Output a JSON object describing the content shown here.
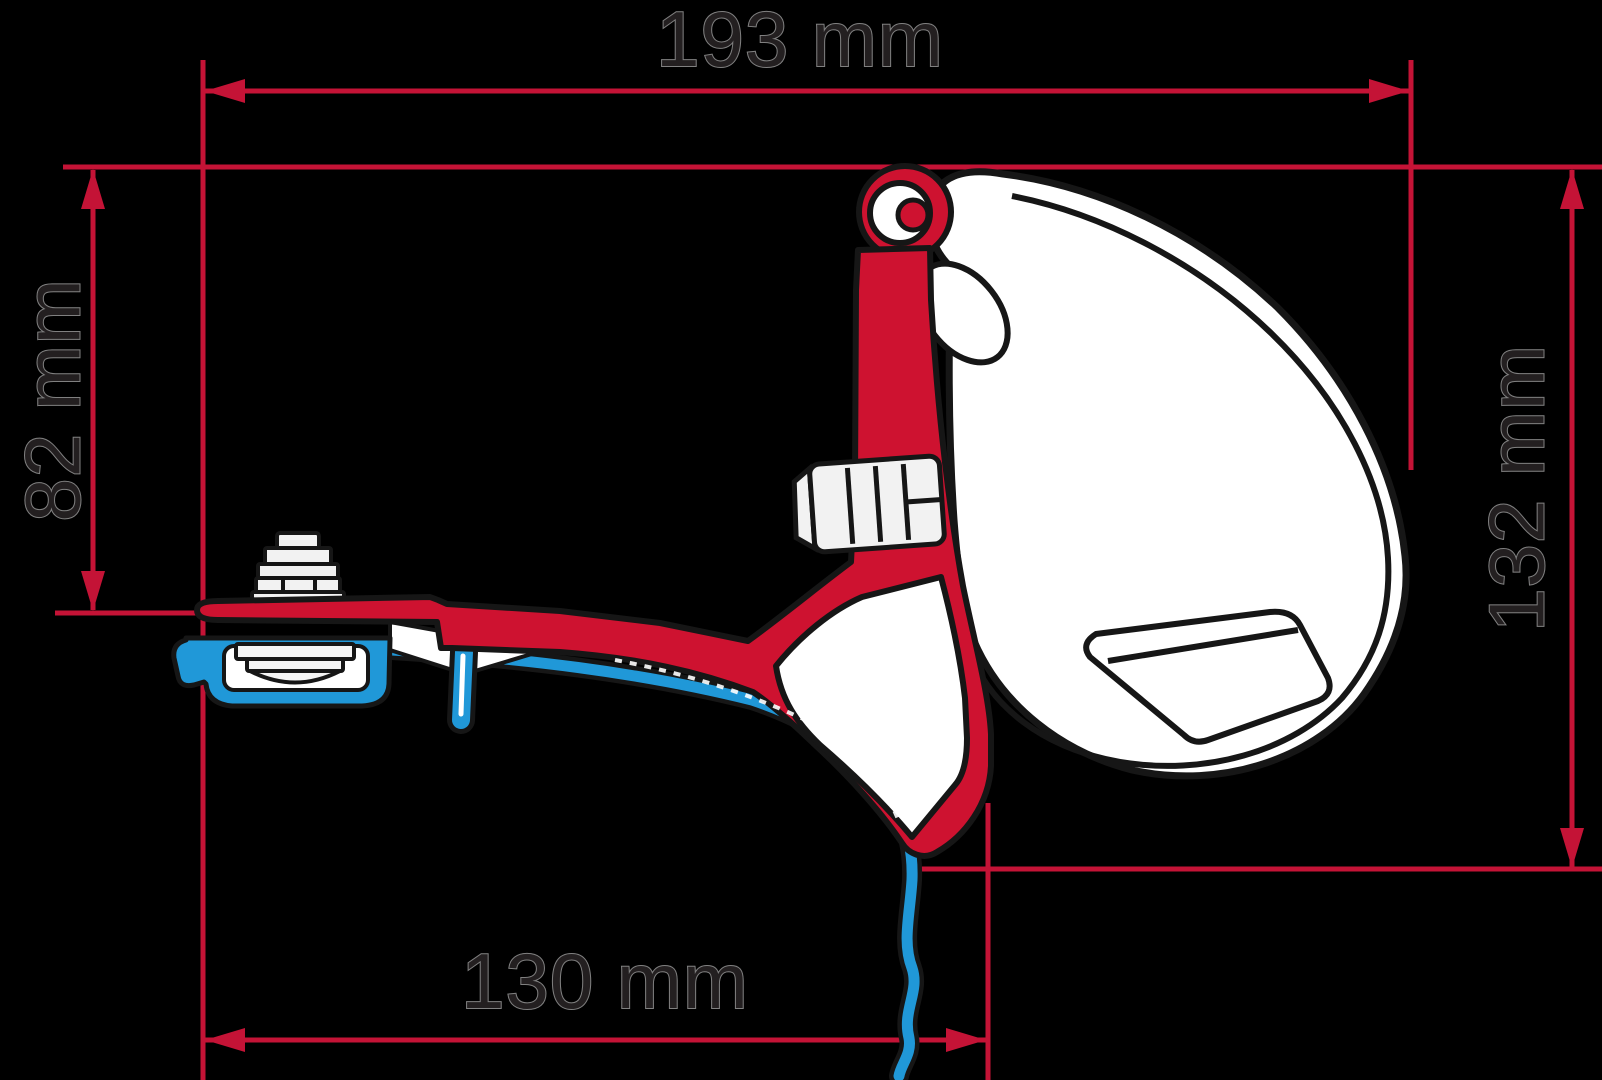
{
  "diagram": {
    "type": "technical-dimension-drawing",
    "subject": "awning-adapter-bracket-cross-section",
    "dimensions": {
      "top": "193 mm",
      "left": "82 mm",
      "right": "132 mm",
      "bottom": "130 mm"
    },
    "colors": {
      "background": "#000000",
      "dimension_line_red": "#c41336",
      "bracket_red": "#ce1230",
      "rail_blue": "#2098d8",
      "outline_black": "#161616",
      "artwork_white": "#ffffff",
      "text_dark": "#231f20"
    }
  }
}
